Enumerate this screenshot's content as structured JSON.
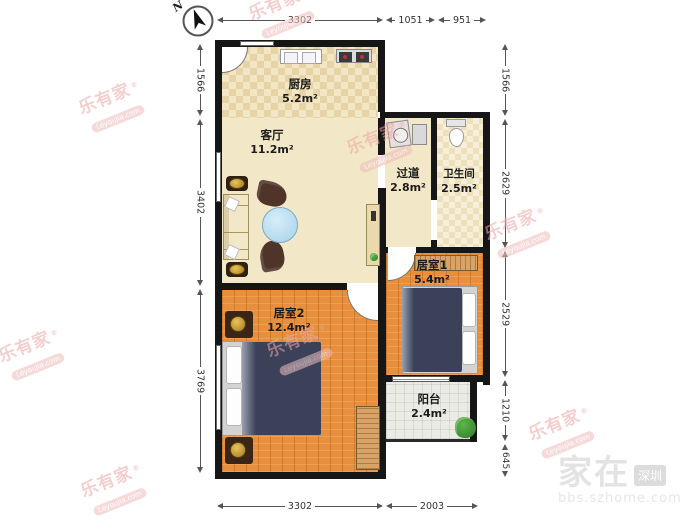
{
  "plan": {
    "compass_label": "N",
    "rooms": [
      {
        "name": "厨房",
        "area": "5.2m²"
      },
      {
        "name": "客厅",
        "area": "11.2m²"
      },
      {
        "name": "过道",
        "area": "2.8m²"
      },
      {
        "name": "卫生间",
        "area": "2.5m²"
      },
      {
        "name": "居室1",
        "area": "5.4m²"
      },
      {
        "name": "居室2",
        "area": "12.4m²"
      },
      {
        "name": "阳台",
        "area": "2.4m²"
      }
    ],
    "dimensions_mm": {
      "top": [
        "3302",
        "1051",
        "951"
      ],
      "bottom": [
        "3302",
        "2003"
      ],
      "left": [
        "1566",
        "3402",
        "3769"
      ],
      "right": [
        "1566",
        "2629",
        "2529",
        "1210",
        "645"
      ]
    },
    "watermarks": {
      "brand": {
        "name": "乐有家",
        "reg": "®",
        "domain": "Leyoujia.com"
      },
      "forum": {
        "big": "家在",
        "badge": "深圳",
        "url": "bbs.szhome.com"
      }
    },
    "colors": {
      "wall": "#161616",
      "wood_floor": "#e78f3c",
      "tile_floor": "#f2e6c4",
      "brand_watermark": "#eba7a7",
      "bed_blanket": "#3b4158"
    }
  }
}
